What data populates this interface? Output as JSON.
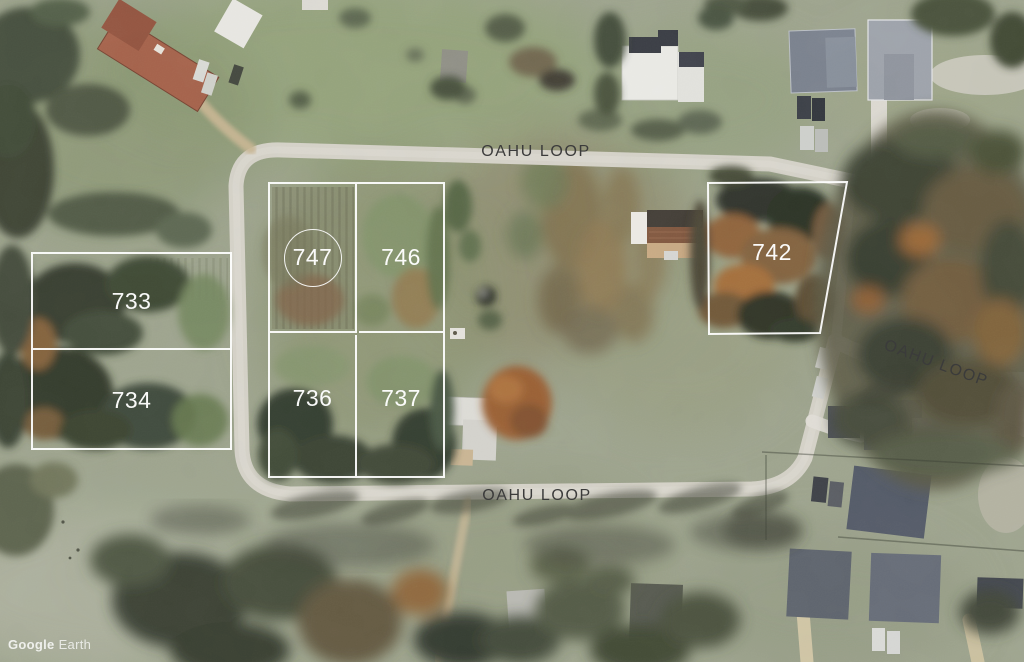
{
  "map": {
    "source_label": {
      "brand": "Google",
      "product": "Earth"
    },
    "road_labels": [
      {
        "id": "top",
        "text": "OAHU LOOP"
      },
      {
        "id": "east",
        "text": "OAHU LOOP"
      },
      {
        "id": "south",
        "text": "OAHU LOOP"
      }
    ],
    "lots": [
      {
        "number": "733",
        "circled": false
      },
      {
        "number": "734",
        "circled": false
      },
      {
        "number": "747",
        "circled": true
      },
      {
        "number": "746",
        "circled": false
      },
      {
        "number": "736",
        "circled": false
      },
      {
        "number": "737",
        "circled": false
      },
      {
        "number": "742",
        "circled": false
      }
    ],
    "colors": {
      "lot_boundary": "#ffffff",
      "road_label_text": "#3b3b3b"
    }
  }
}
